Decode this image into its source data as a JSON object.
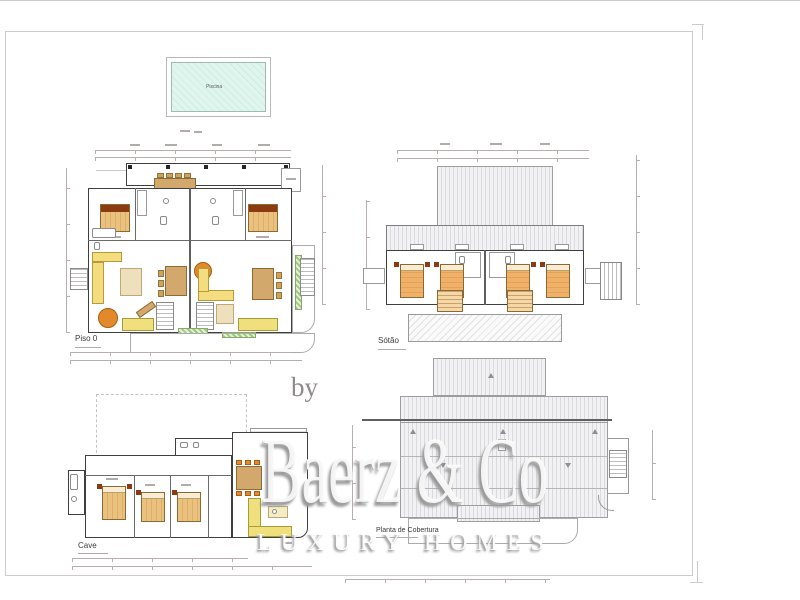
{
  "sheet": {
    "background": "#ffffff",
    "border_color": "#cfc9c9"
  },
  "pool": {
    "label": "Piscina"
  },
  "plans": {
    "piso0": {
      "label": "Piso 0"
    },
    "sotao": {
      "label": "Sótão"
    },
    "cave": {
      "label": "Cave"
    },
    "cobertura": {
      "label": "Planta de Cobertura"
    }
  },
  "watermark": {
    "prefix": "by",
    "brand": "Baerz & Co",
    "tagline": "LUXURY HOMES"
  },
  "colors": {
    "wall": "#3f3f3f",
    "bed": "#eac17e",
    "bed_accent": "#8c3a12",
    "sofa": "#f3dd7f",
    "table_round": "#e2892b",
    "table_wood": "#d2a86c",
    "kitchen": "#efe07d",
    "plants": "#9fc87c",
    "pool_water": "#dff5ee",
    "wm_shadow": "#9a9a9a"
  }
}
